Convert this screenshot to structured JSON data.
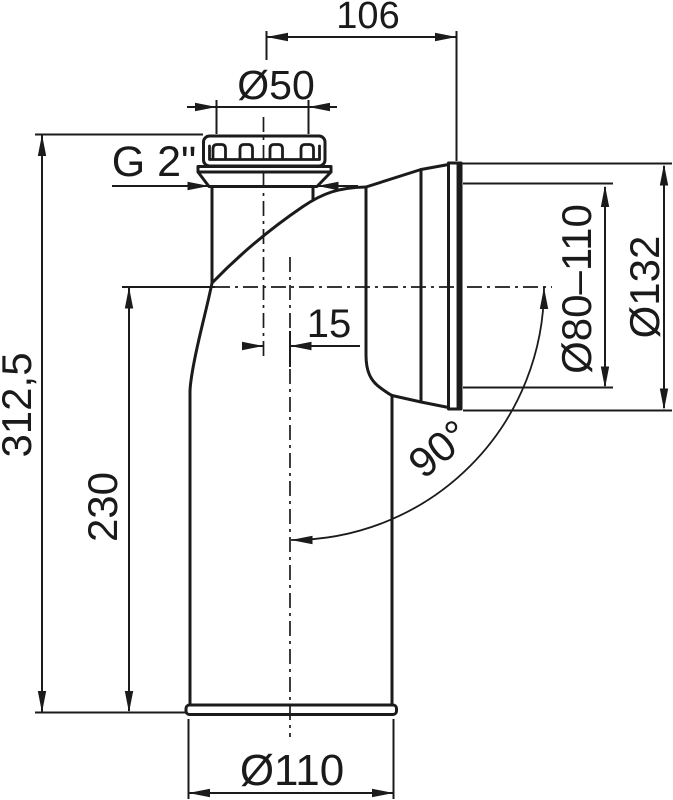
{
  "drawing": {
    "background": "#ffffff",
    "line_color": "#1b1b1b",
    "labels": {
      "top_width": "106",
      "inlet_diameter": "Ø50",
      "thread_size": "G 2\"",
      "center_offset": "15",
      "outlet_inner_diameter": "Ø80–110",
      "outlet_outer_diameter": "Ø132",
      "bend_angle": "90°",
      "total_height": "312,5",
      "body_height": "230",
      "pipe_diameter": "Ø110"
    }
  }
}
